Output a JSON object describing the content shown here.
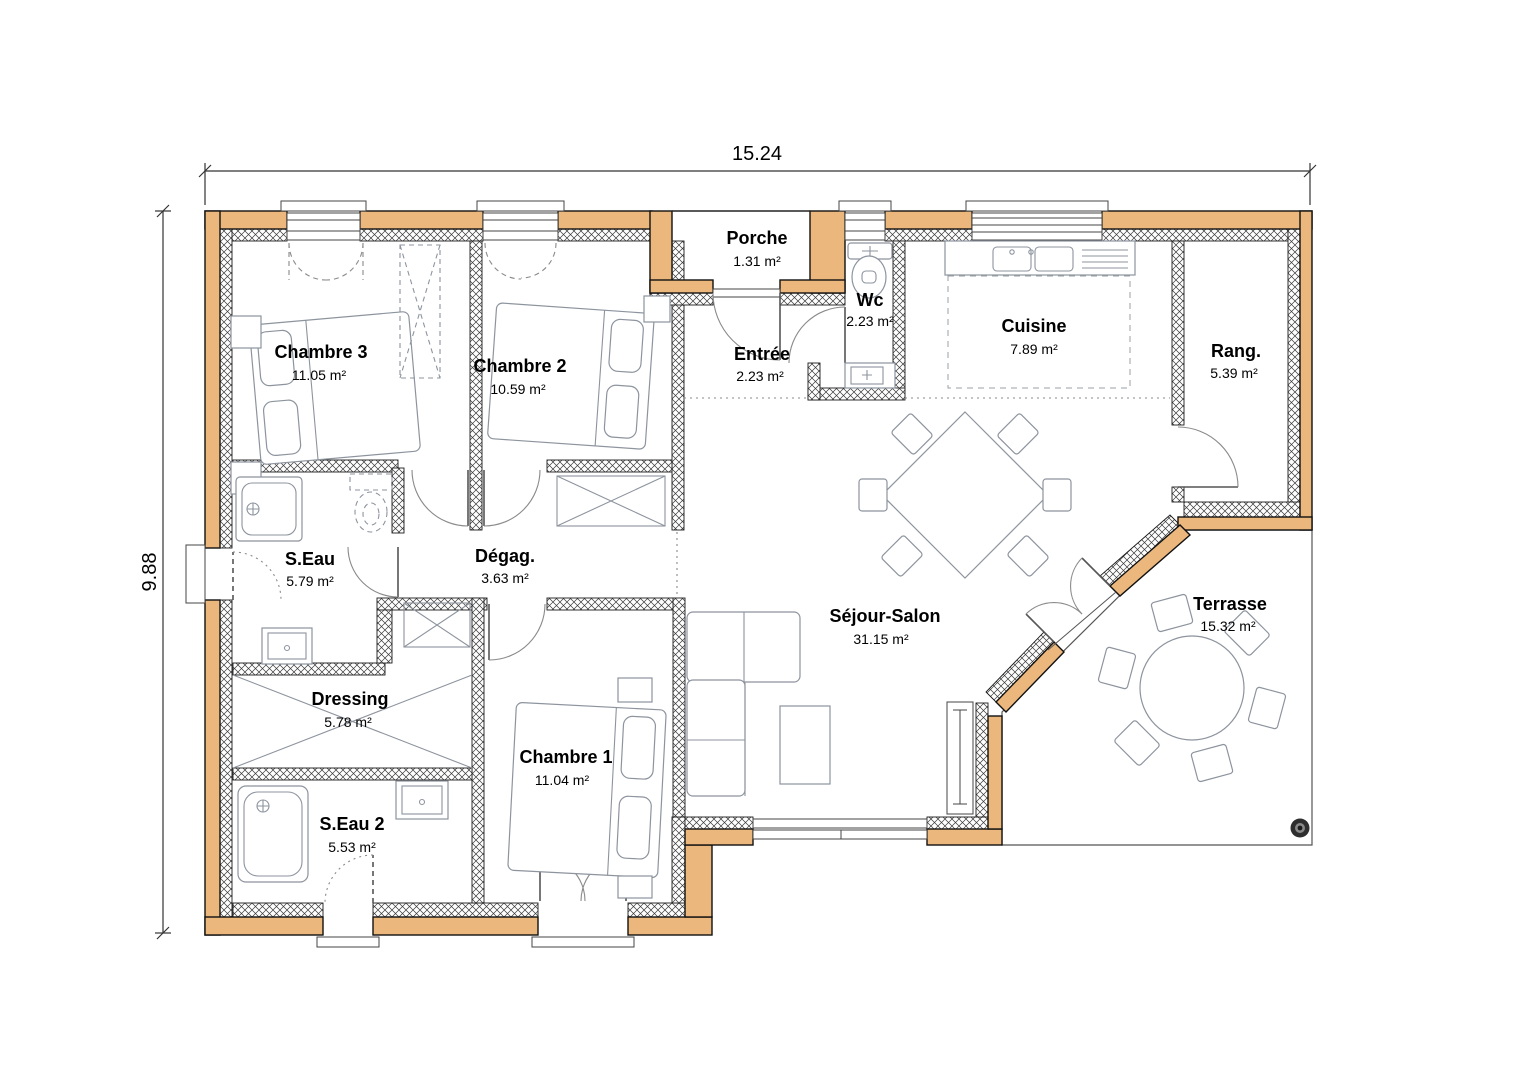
{
  "plan_title": "Plan de maison plain-pied",
  "dimensions": {
    "width": "15.24",
    "height": "9.88"
  },
  "colors": {
    "wall_fill": "#EBB77C",
    "wall_stroke": "#111111",
    "furniture_stroke": "#8d949e"
  },
  "watermark": {
    "icon": "dot-logo"
  },
  "rooms": [
    {
      "name": "Chambre 3",
      "area": "11.05 m²"
    },
    {
      "name": "Chambre 2",
      "area": "10.59 m²"
    },
    {
      "name": "Porche",
      "area": "1.31 m²"
    },
    {
      "name": "Entrée",
      "area": "2.23 m²"
    },
    {
      "name": "Wc",
      "area": "2.23 m²"
    },
    {
      "name": "Cuisine",
      "area": "7.89 m²"
    },
    {
      "name": "Rang.",
      "area": "5.39 m²"
    },
    {
      "name": "S.Eau",
      "area": "5.79 m²"
    },
    {
      "name": "Dégag.",
      "area": "3.63 m²"
    },
    {
      "name": "Dressing",
      "area": "5.78 m²"
    },
    {
      "name": "S.Eau 2",
      "area": "5.53 m²"
    },
    {
      "name": "Chambre 1",
      "area": "11.04 m²"
    },
    {
      "name": "Séjour-Salon",
      "area": "31.15 m²"
    },
    {
      "name": "Terrasse",
      "area": "15.32 m²"
    }
  ]
}
